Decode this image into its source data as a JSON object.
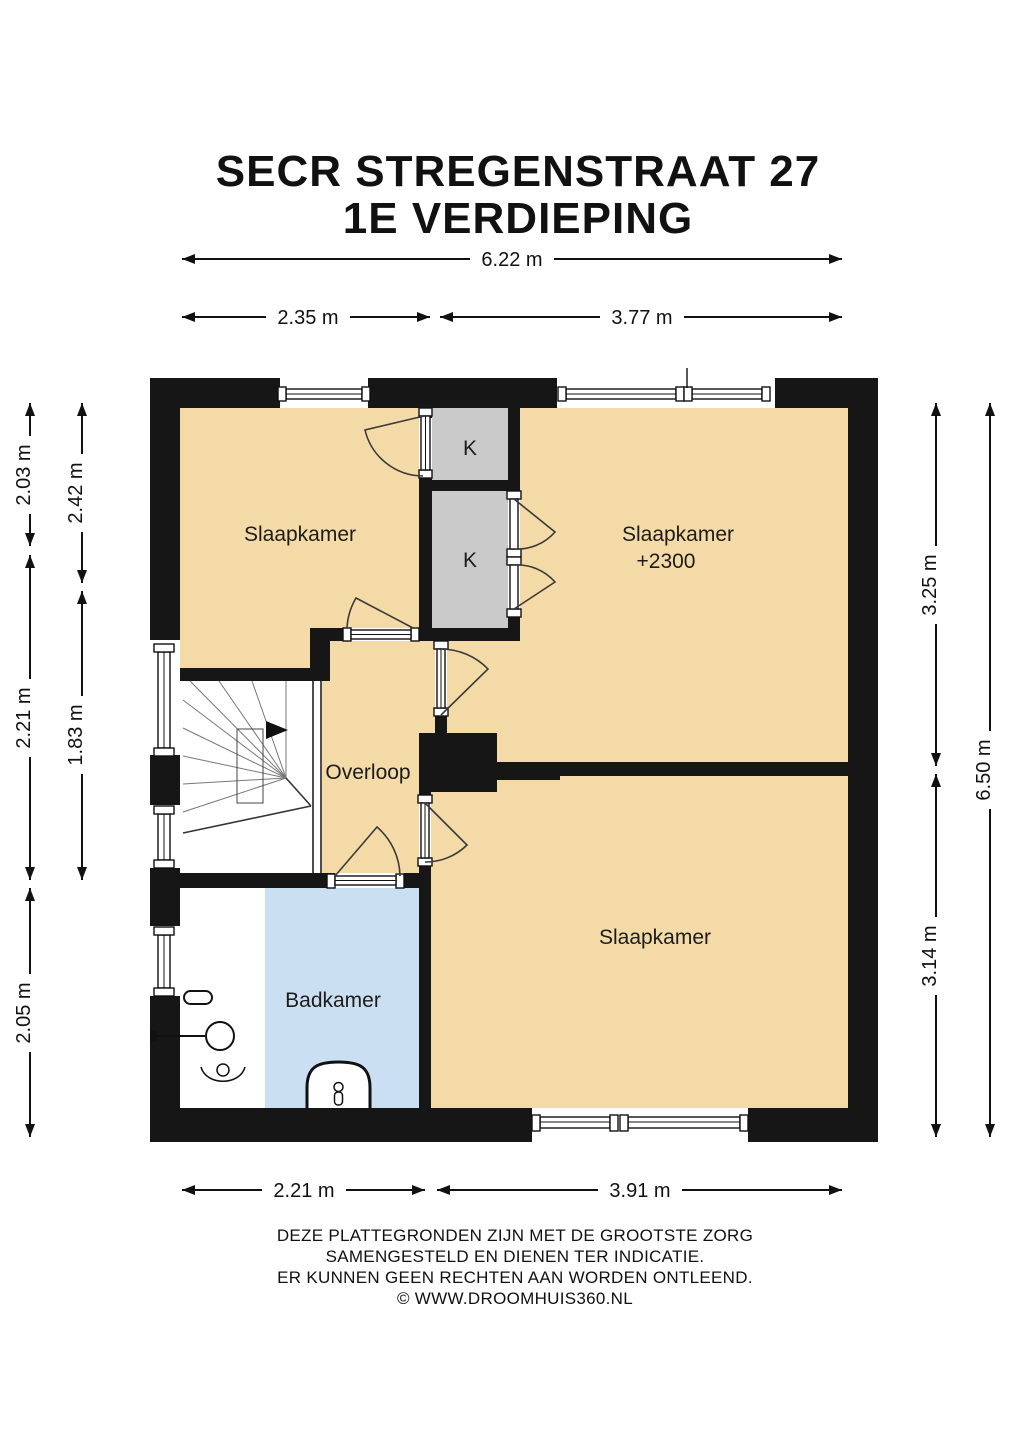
{
  "title": {
    "line1": "SECR STREGENSTRAAT 27",
    "line2": "1E VERDIEPING"
  },
  "rooms": {
    "bedroom_top_left": {
      "label": "Slaapkamer"
    },
    "bedroom_top_right": {
      "label": "Slaapkamer",
      "sub": "+2300"
    },
    "bedroom_bottom": {
      "label": "Slaapkamer"
    },
    "landing": {
      "label": "Overloop"
    },
    "bathroom": {
      "label": "Badkamer"
    },
    "closet_upper": {
      "label": "K"
    },
    "closet_lower": {
      "label": "K"
    }
  },
  "dimensions": {
    "top_total": "6.22 m",
    "top_left": "2.35 m",
    "top_right": "3.77 m",
    "left_outer": [
      "2.03 m",
      "2.21 m",
      "2.05 m"
    ],
    "left_inner": [
      "2.42 m",
      "1.83 m"
    ],
    "right_inner": [
      "3.25 m",
      "3.14 m"
    ],
    "right_outer": "6.50 m",
    "bottom_left": "2.21 m",
    "bottom_right": "3.91 m"
  },
  "footer": {
    "line1": "DEZE PLATTEGRONDEN ZIJN MET DE GROOTSTE ZORG",
    "line2": "SAMENGESTELD EN DIENEN TER INDICATIE.",
    "line3": "ER KUNNEN GEEN RECHTEN AAN WORDEN ONTLEEND.",
    "line4": "© WWW.DROOMHUIS360.NL"
  },
  "colors": {
    "floor": "#F4DAA7",
    "bathroom": "#CBDFF2",
    "closet": "#CACACA",
    "wall": "#161616"
  }
}
